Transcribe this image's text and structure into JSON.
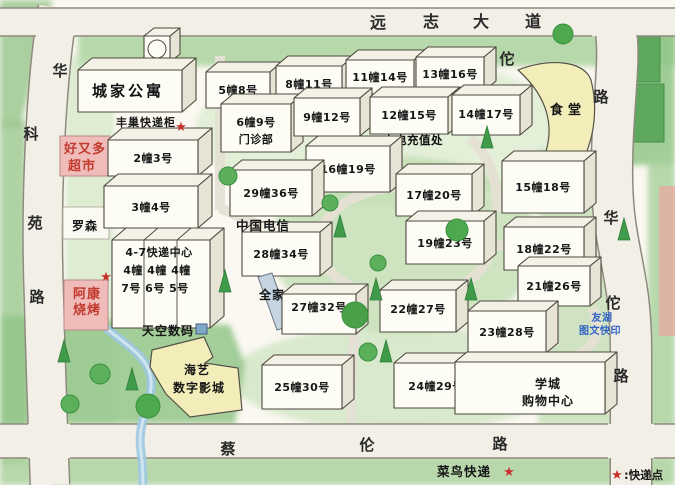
{
  "roads": {
    "top": {
      "chars": [
        "远",
        "志",
        "大",
        "道"
      ]
    },
    "left": {
      "chars": [
        "华",
        "科",
        "苑",
        "路"
      ]
    },
    "right_entry": {
      "chars": [
        "佗",
        "路"
      ]
    },
    "right_side": {
      "chars": [
        "华",
        "佗",
        "路"
      ]
    },
    "bottom": {
      "chars": [
        "蔡",
        "伦",
        "路"
      ]
    }
  },
  "buildings": [
    {
      "label": "5幢8号"
    },
    {
      "label": "8幢11号"
    },
    {
      "label": "11幢14号"
    },
    {
      "label": "13幢16号"
    },
    {
      "label": "6幢9号",
      "label2": "门诊部"
    },
    {
      "label": "9幢12号"
    },
    {
      "label": "12幢15号",
      "note": "水电充值处"
    },
    {
      "label": "14幢17号"
    },
    {
      "label": "16幢19号"
    },
    {
      "label": "29幢36号"
    },
    {
      "label": "17幢20号"
    },
    {
      "label": "15幢18号"
    },
    {
      "label": "28幢34号"
    },
    {
      "label": "19幢23号"
    },
    {
      "label": "18幢22号"
    },
    {
      "label": "21幢26号"
    },
    {
      "label": "27幢32号"
    },
    {
      "label": "22幢27号"
    },
    {
      "label": "23幢28号"
    },
    {
      "label": "25幢30号"
    },
    {
      "label": "24幢29号"
    },
    {
      "label": "2幢3号"
    },
    {
      "label": "3幢4号"
    }
  ],
  "express_center": {
    "title": "4-7快递中心",
    "row1": "4幢 4幢 4幢",
    "row2": "7号 6号 5号"
  },
  "places": {
    "apartment": "城家公寓",
    "locker": "丰巢快递柜",
    "supermarket_line1": "好又多",
    "supermarket_line2": "超市",
    "lawson": "罗森",
    "bbq_line1": "阿康",
    "bbq_line2": "烧烤",
    "digital_store": "天空数码",
    "cinema_line1": "海艺",
    "cinema_line2": "数字影城",
    "telecom": "中国电信",
    "familymart": "全家",
    "canteen": "食堂",
    "mall_line1": "学城",
    "mall_line2": "购物中心",
    "print_line1": "友湖",
    "print_line2": "图文快印",
    "cainiao": "菜鸟快递"
  },
  "legend": {
    "star": "★",
    "label": ":快递点"
  },
  "icons": {
    "star": "★"
  },
  "colors": {
    "star_red": "#c8302a",
    "shop_text_red": "#c23a2e",
    "building_yellow": "#f3edb9",
    "shop_pink": "#f0bcba",
    "print_blue": "#2f62c4",
    "lawn_green": "#aed3a0",
    "road_grey": "#f2efe6"
  }
}
